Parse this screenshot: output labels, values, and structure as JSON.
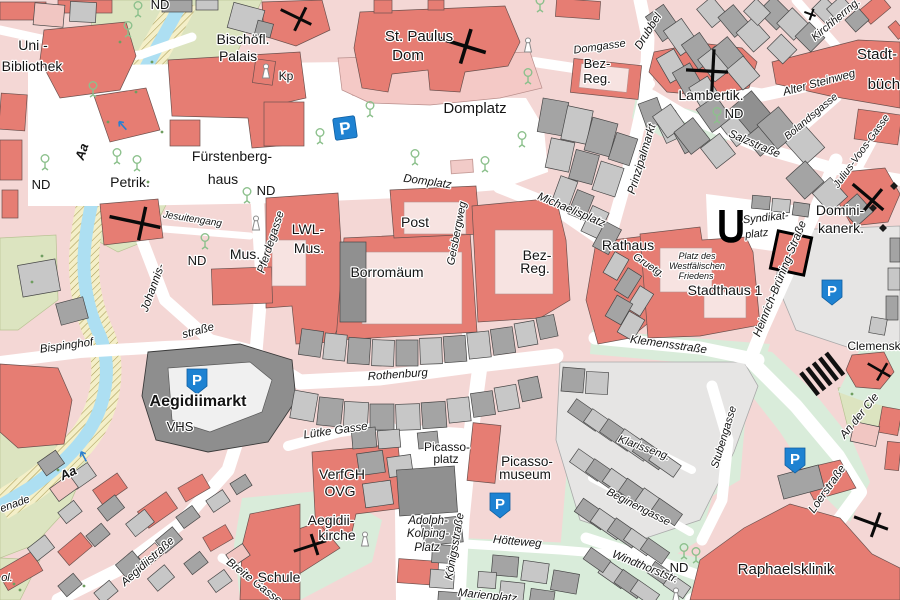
{
  "map": {
    "type": "city-street-map",
    "colors": {
      "block_pink": "#f4d7d5",
      "building_salmon": "#e67d73",
      "courtyard_pale": "#f7e3e1",
      "building_gray_dark": "#a4a4a4",
      "building_gray_light": "#c7c7c7",
      "building_gray_darker": "#909090",
      "plaza_gray": "#e6e5e4",
      "green_mint": "#d9ecda",
      "green_olive": "#dce4c0",
      "water_blue": "#addff2",
      "promenade_yellow": "#f4efc8",
      "parking_blue": "#1e82d2",
      "label_black": "#141414",
      "tree_green": "#8cc08c"
    },
    "labels": [
      {
        "text": "ND",
        "x": 160,
        "y": 9,
        "size": 13,
        "rot": 0,
        "cls": "p"
      },
      {
        "text": "Uni -",
        "x": 33,
        "y": 50,
        "size": 14,
        "rot": 0,
        "cls": "p"
      },
      {
        "text": "Bibliothek",
        "x": 32,
        "y": 71,
        "size": 14,
        "rot": 0,
        "cls": "p"
      },
      {
        "text": "Bischöfl.",
        "x": 243,
        "y": 44,
        "size": 14,
        "rot": 0,
        "cls": "p"
      },
      {
        "text": "Palais",
        "x": 238,
        "y": 61,
        "size": 14,
        "rot": 0,
        "cls": "p"
      },
      {
        "text": "Kp",
        "x": 286,
        "y": 80,
        "size": 12,
        "rot": 0,
        "cls": "p"
      },
      {
        "text": "ND",
        "x": 41,
        "y": 189,
        "size": 13,
        "rot": 0,
        "cls": "p"
      },
      {
        "text": "Petrik.",
        "x": 130,
        "y": 187,
        "size": 14,
        "rot": 0,
        "cls": "p"
      },
      {
        "text": "Fürstenberg-",
        "x": 232,
        "y": 161,
        "size": 14,
        "rot": 0,
        "cls": "p"
      },
      {
        "text": "haus",
        "x": 223,
        "y": 184,
        "size": 14,
        "rot": 0,
        "cls": "p"
      },
      {
        "text": "ND",
        "x": 266,
        "y": 195,
        "size": 13,
        "rot": 0,
        "cls": "p"
      },
      {
        "text": "Jesuitengang",
        "x": 192,
        "y": 222,
        "size": 10,
        "rot": 9,
        "cls": "s"
      },
      {
        "text": "ND",
        "x": 197,
        "y": 265,
        "size": 13,
        "rot": 0,
        "cls": "p"
      },
      {
        "text": "Mus.",
        "x": 245,
        "y": 259,
        "size": 14,
        "rot": 0,
        "cls": "p"
      },
      {
        "text": "Pferdegasse",
        "x": 274,
        "y": 243,
        "size": 11.5,
        "rot": -72,
        "cls": "s"
      },
      {
        "text": "LWL-",
        "x": 308,
        "y": 234,
        "size": 14,
        "rot": 0,
        "cls": "p"
      },
      {
        "text": "Mus.",
        "x": 309,
        "y": 253,
        "size": 14,
        "rot": 0,
        "cls": "p"
      },
      {
        "text": "Post",
        "x": 415,
        "y": 227,
        "size": 14,
        "rot": 0,
        "cls": "p"
      },
      {
        "text": "Borromäum",
        "x": 387,
        "y": 277,
        "size": 14,
        "rot": 0,
        "cls": "p"
      },
      {
        "text": "Geisbergweg",
        "x": 460,
        "y": 234,
        "size": 11,
        "rot": -79,
        "cls": "s"
      },
      {
        "text": "Bez-",
        "x": 537,
        "y": 260,
        "size": 14,
        "rot": 0,
        "cls": "p"
      },
      {
        "text": "Reg.",
        "x": 535,
        "y": 273,
        "size": 14,
        "rot": 0,
        "cls": "p"
      },
      {
        "text": "St. Paulus",
        "x": 419,
        "y": 41,
        "size": 15,
        "rot": 0,
        "cls": "p"
      },
      {
        "text": "Dom",
        "x": 408,
        "y": 60,
        "size": 15,
        "rot": 0,
        "cls": "p"
      },
      {
        "text": "Domplatz",
        "x": 475,
        "y": 113,
        "size": 15,
        "rot": 0,
        "cls": "p"
      },
      {
        "text": "Domplatz",
        "x": 427,
        "y": 185,
        "size": 11.5,
        "rot": 8,
        "cls": "s"
      },
      {
        "text": "Domgasse",
        "x": 600,
        "y": 50,
        "size": 11,
        "rot": -8,
        "cls": "s"
      },
      {
        "text": "Bez-",
        "x": 597,
        "y": 68,
        "size": 13,
        "rot": 0,
        "cls": "p"
      },
      {
        "text": "Reg.",
        "x": 597,
        "y": 83,
        "size": 13,
        "rot": 0,
        "cls": "p"
      },
      {
        "text": "Lambertik.",
        "x": 711,
        "y": 100,
        "size": 14,
        "rot": 0,
        "cls": "p"
      },
      {
        "text": "ND",
        "x": 734,
        "y": 118,
        "size": 13,
        "rot": 0,
        "cls": "p"
      },
      {
        "text": "Drubbel",
        "x": 651,
        "y": 33,
        "size": 11.5,
        "rot": -58,
        "cls": "s"
      },
      {
        "text": "Prinzipalmarkt",
        "x": 645,
        "y": 160,
        "size": 11.5,
        "rot": -73,
        "cls": "s"
      },
      {
        "text": "Michaelisplatz",
        "x": 570,
        "y": 213,
        "size": 11.5,
        "rot": 23,
        "cls": "s"
      },
      {
        "text": "Rathaus",
        "x": 628,
        "y": 250,
        "size": 14,
        "rot": 0,
        "cls": "p"
      },
      {
        "text": "Gruetg.",
        "x": 647,
        "y": 268,
        "size": 10.5,
        "rot": 34,
        "cls": "s"
      },
      {
        "text": "Platz des",
        "x": 697,
        "y": 259,
        "size": 9,
        "rot": 0,
        "cls": "f"
      },
      {
        "text": "Westfälischen",
        "x": 697,
        "y": 269,
        "size": 9,
        "rot": 0,
        "cls": "f"
      },
      {
        "text": "Friedens",
        "x": 696,
        "y": 279,
        "size": 9,
        "rot": 0,
        "cls": "f"
      },
      {
        "text": "Stadthaus 1",
        "x": 725,
        "y": 295,
        "size": 14,
        "rot": 0,
        "cls": "p"
      },
      {
        "text": "Syndikat-",
        "x": 766,
        "y": 221,
        "size": 11,
        "rot": -6,
        "cls": "s"
      },
      {
        "text": "platz",
        "x": 757,
        "y": 237,
        "size": 11,
        "rot": -6,
        "cls": "s"
      },
      {
        "text": "Heinrich-Brüning-Straße",
        "x": 783,
        "y": 280,
        "size": 11.5,
        "rot": -68,
        "cls": "s"
      },
      {
        "text": "Domini-",
        "x": 840,
        "y": 215,
        "size": 14,
        "rot": 0,
        "cls": "p"
      },
      {
        "text": "kanerk.",
        "x": 841,
        "y": 233,
        "size": 14,
        "rot": 0,
        "cls": "p"
      },
      {
        "text": "Kirchherrng.",
        "x": 838,
        "y": 22,
        "size": 11,
        "rot": -40,
        "cls": "s"
      },
      {
        "text": "Alter Steinweg",
        "x": 820,
        "y": 86,
        "size": 11.5,
        "rot": -15,
        "cls": "s"
      },
      {
        "text": "Stadt-",
        "x": 877,
        "y": 59,
        "size": 15,
        "rot": 0,
        "cls": "p"
      },
      {
        "text": "büche",
        "x": 888,
        "y": 89,
        "size": 15,
        "rot": 0,
        "cls": "p"
      },
      {
        "text": "Salzstraße",
        "x": 753,
        "y": 147,
        "size": 11.5,
        "rot": 23,
        "cls": "s"
      },
      {
        "text": "Bolandsgasse",
        "x": 813,
        "y": 119,
        "size": 10.5,
        "rot": -40,
        "cls": "s"
      },
      {
        "text": "Julius-Voos-Gasse",
        "x": 864,
        "y": 153,
        "size": 10.5,
        "rot": -54,
        "cls": "s"
      },
      {
        "text": "Klemensstraße",
        "x": 668,
        "y": 348,
        "size": 11.5,
        "rot": 8,
        "cls": "s"
      },
      {
        "text": "Rothenburg",
        "x": 398,
        "y": 378,
        "size": 11.5,
        "rot": -4,
        "cls": "s"
      },
      {
        "text": "Johannis-",
        "x": 156,
        "y": 289,
        "size": 11.5,
        "rot": -70,
        "cls": "s"
      },
      {
        "text": "straße",
        "x": 199,
        "y": 334,
        "size": 11.5,
        "rot": -15,
        "cls": "s"
      },
      {
        "text": "Bispinghof",
        "x": 67,
        "y": 349,
        "size": 11.5,
        "rot": -8,
        "cls": "s"
      },
      {
        "text": "Aa",
        "x": 86,
        "y": 153,
        "size": 13,
        "rot": -72,
        "cls": "w"
      },
      {
        "text": "Aa",
        "x": 70,
        "y": 477,
        "size": 13,
        "rot": -25,
        "cls": "w"
      },
      {
        "text": "enade",
        "x": 16,
        "y": 507,
        "size": 11,
        "rot": -20,
        "cls": "s"
      },
      {
        "text": "Aegidiimarkt",
        "x": 198,
        "y": 406,
        "size": 16,
        "rot": 0,
        "cls": "b"
      },
      {
        "text": "VHS",
        "x": 180,
        "y": 431,
        "size": 13,
        "rot": 0,
        "cls": "p"
      },
      {
        "text": "Lütke Gasse",
        "x": 336,
        "y": 434,
        "size": 11.5,
        "rot": -8,
        "cls": "s"
      },
      {
        "text": "VerfGH",
        "x": 342,
        "y": 479,
        "size": 14,
        "rot": 0,
        "cls": "p"
      },
      {
        "text": "OVG",
        "x": 340,
        "y": 496,
        "size": 14,
        "rot": 0,
        "cls": "p"
      },
      {
        "text": "Aegidii-",
        "x": 331,
        "y": 525,
        "size": 14,
        "rot": 0,
        "cls": "p"
      },
      {
        "text": "kirche",
        "x": 337,
        "y": 540,
        "size": 14,
        "rot": 0,
        "cls": "p"
      },
      {
        "text": "Picasso-",
        "x": 447,
        "y": 451,
        "size": 12,
        "rot": 0,
        "cls": "p"
      },
      {
        "text": "platz",
        "x": 446,
        "y": 463,
        "size": 12,
        "rot": 0,
        "cls": "p"
      },
      {
        "text": "Picasso-",
        "x": 527,
        "y": 466,
        "size": 13.5,
        "rot": 0,
        "cls": "p"
      },
      {
        "text": "museum",
        "x": 525,
        "y": 479,
        "size": 13.5,
        "rot": 0,
        "cls": "p"
      },
      {
        "text": "Adolph-",
        "x": 428,
        "y": 524,
        "size": 11.5,
        "rot": 0,
        "cls": "s"
      },
      {
        "text": "Kolping-",
        "x": 428,
        "y": 537,
        "size": 11.5,
        "rot": 0,
        "cls": "s"
      },
      {
        "text": "Platz",
        "x": 427,
        "y": 551,
        "size": 11.5,
        "rot": 0,
        "cls": "s"
      },
      {
        "text": "Königsstraße",
        "x": 458,
        "y": 547,
        "size": 11.5,
        "rot": -80,
        "cls": "s"
      },
      {
        "text": "Aegidiistraße",
        "x": 150,
        "y": 564,
        "size": 11.5,
        "rot": -42,
        "cls": "s"
      },
      {
        "text": "Breite Gasse",
        "x": 252,
        "y": 584,
        "size": 11.5,
        "rot": 38,
        "cls": "s"
      },
      {
        "text": "Schule",
        "x": 279,
        "y": 582,
        "size": 14,
        "rot": 0,
        "cls": "p"
      },
      {
        "text": "ol.",
        "x": 7,
        "y": 581,
        "size": 11,
        "rot": 0,
        "cls": "s"
      },
      {
        "text": "Hötteweg",
        "x": 517,
        "y": 545,
        "size": 11.5,
        "rot": 5,
        "cls": "s"
      },
      {
        "text": "Marienplatz",
        "x": 487,
        "y": 599,
        "size": 11.5,
        "rot": 6,
        "cls": "s"
      },
      {
        "text": "Windthorststr.",
        "x": 644,
        "y": 570,
        "size": 11.5,
        "rot": 22,
        "cls": "s"
      },
      {
        "text": "ND",
        "x": 679,
        "y": 572,
        "size": 13,
        "rot": 0,
        "cls": "p"
      },
      {
        "text": "Klarisseng.",
        "x": 643,
        "y": 451,
        "size": 11,
        "rot": 20,
        "cls": "s"
      },
      {
        "text": "Beginengasse",
        "x": 637,
        "y": 510,
        "size": 11,
        "rot": 27,
        "cls": "s"
      },
      {
        "text": "Stubengasse",
        "x": 727,
        "y": 438,
        "size": 11,
        "rot": -73,
        "cls": "s"
      },
      {
        "text": "Raphaelsklinik",
        "x": 786,
        "y": 574,
        "size": 15,
        "rot": 0,
        "cls": "p"
      },
      {
        "text": "Loerstraße",
        "x": 830,
        "y": 491,
        "size": 11.5,
        "rot": -55,
        "cls": "s"
      },
      {
        "text": "An der Cle",
        "x": 862,
        "y": 418,
        "size": 11.5,
        "rot": -51,
        "cls": "s"
      },
      {
        "text": "Clemensk",
        "x": 874,
        "y": 350,
        "size": 12,
        "rot": 0,
        "cls": "p"
      }
    ],
    "icons": {
      "parking_square": [
        {
          "x": 345,
          "y": 128,
          "rot": -8,
          "label": "P"
        }
      ],
      "parking_shield": [
        {
          "x": 197,
          "y": 381,
          "label": "P"
        },
        {
          "x": 500,
          "y": 505,
          "label": "P"
        },
        {
          "x": 832,
          "y": 292,
          "label": "P"
        },
        {
          "x": 795,
          "y": 460,
          "label": "P"
        }
      ],
      "church_crosses": [
        {
          "x": 458,
          "y": 44,
          "rot": 17,
          "h": 58,
          "v": 36,
          "sw": 3.6
        },
        {
          "x": 296,
          "y": 17,
          "rot": 26,
          "h": 34,
          "v": 26,
          "sw": 3
        },
        {
          "x": 135,
          "y": 222,
          "rot": 12,
          "h": 52,
          "v": 34,
          "sw": 3.4
        },
        {
          "x": 707,
          "y": 71,
          "rot": 3,
          "h": 42,
          "v": 44,
          "sw": 3.2
        },
        {
          "x": 310,
          "y": 546,
          "rot": -18,
          "h": 34,
          "v": 22,
          "sw": 3
        },
        {
          "x": 868,
          "y": 197,
          "rot": 40,
          "h": 40,
          "v": 30,
          "sw": 3.2
        },
        {
          "x": 879,
          "y": 370,
          "rot": 30,
          "h": 26,
          "v": 20,
          "sw": 2.6
        },
        {
          "x": 871,
          "y": 523,
          "rot": 20,
          "h": 36,
          "v": 26,
          "sw": 3
        },
        {
          "x": 810,
          "y": 14,
          "rot": 20,
          "h": 12,
          "v": 12,
          "sw": 2
        }
      ],
      "trees": [
        {
          "x": 138,
          "y": 10
        },
        {
          "x": 540,
          "y": 5
        },
        {
          "x": 93,
          "y": 90
        },
        {
          "x": 117,
          "y": 157
        },
        {
          "x": 137,
          "y": 164
        },
        {
          "x": 45,
          "y": 163
        },
        {
          "x": 128,
          "y": 30
        },
        {
          "x": 370,
          "y": 110
        },
        {
          "x": 320,
          "y": 137
        },
        {
          "x": 415,
          "y": 158
        },
        {
          "x": 485,
          "y": 165
        },
        {
          "x": 528,
          "y": 77
        },
        {
          "x": 522,
          "y": 140
        },
        {
          "x": 717,
          "y": 116
        },
        {
          "x": 247,
          "y": 196
        },
        {
          "x": 205,
          "y": 242
        },
        {
          "x": 684,
          "y": 552
        },
        {
          "x": 696,
          "y": 556
        }
      ],
      "chapels": [
        {
          "x": 528,
          "y": 46
        },
        {
          "x": 256,
          "y": 224
        },
        {
          "x": 266,
          "y": 72
        },
        {
          "x": 365,
          "y": 540
        },
        {
          "x": 676,
          "y": 596
        }
      ],
      "green_dots": [
        {
          "x": 120,
          "y": 42
        },
        {
          "x": 152,
          "y": 62
        },
        {
          "x": 136,
          "y": 92
        },
        {
          "x": 108,
          "y": 122
        },
        {
          "x": 162,
          "y": 132
        },
        {
          "x": 148,
          "y": 182
        },
        {
          "x": 42,
          "y": 256
        },
        {
          "x": 32,
          "y": 282
        },
        {
          "x": 58,
          "y": 470
        },
        {
          "x": 84,
          "y": 586
        },
        {
          "x": 852,
          "y": 394
        },
        {
          "x": 868,
          "y": 406
        },
        {
          "x": 14,
          "y": 584
        },
        {
          "x": 20,
          "y": 590
        }
      ],
      "flow_arrows": [
        {
          "x": 123,
          "y": 126,
          "rot": 228
        },
        {
          "x": 84,
          "y": 457,
          "rot": 242
        }
      ],
      "black_diamonds": [
        {
          "x": 873,
          "y": 208
        },
        {
          "x": 883,
          "y": 228
        },
        {
          "x": 894,
          "y": 186
        }
      ],
      "stairs": {
        "x": 822,
        "y": 374,
        "rot": -38
      },
      "u_monument": {
        "x": 731,
        "y": 224
      },
      "outlined_building": {
        "x": 791,
        "y": 253,
        "rot": 12
      },
      "domplatz_podium": {
        "x": 451,
        "y": 160,
        "rot": -4
      }
    }
  }
}
